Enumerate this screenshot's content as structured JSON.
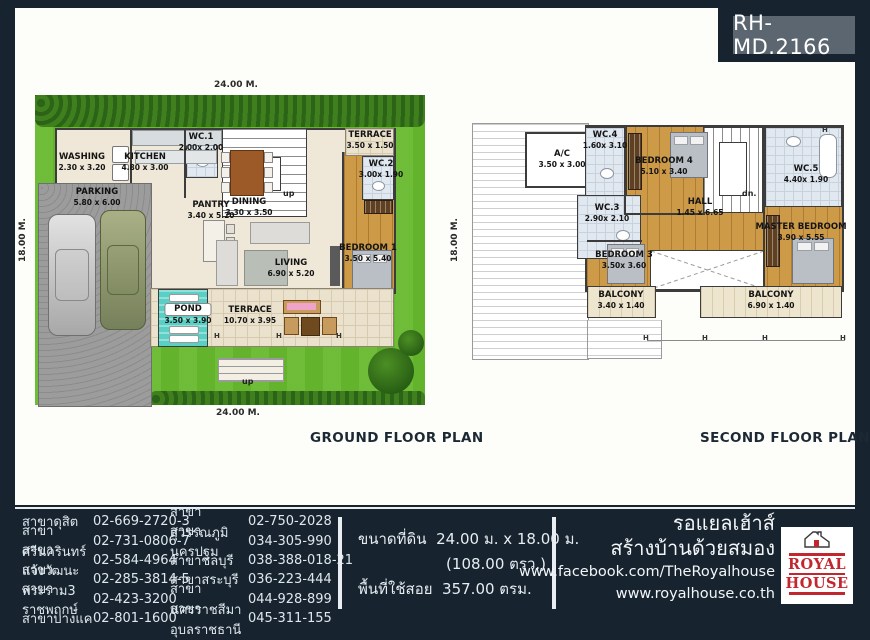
{
  "badge": "RH-MD.2166",
  "marker": "H",
  "ground_floor": {
    "title": "GROUND FLOOR PLAN",
    "dim_top": "24.00 M.",
    "dim_bottom": "24.00 M.",
    "dim_left": "18.00 M.",
    "dim_right": "18.00 M.",
    "stair_up_top": "up",
    "stair_up_bottom": "up",
    "rooms": [
      {
        "name": "WASHING",
        "dims": "2.30 x 3.20"
      },
      {
        "name": "KITCHEN",
        "dims": "4.80 x 3.00"
      },
      {
        "name": "WC.1",
        "dims": "2.00x 2.00"
      },
      {
        "name": "PARKING",
        "dims": "5.80 x 6.00"
      },
      {
        "name": "PANTRY",
        "dims": "3.40 x 5.20"
      },
      {
        "name": "DINING",
        "dims": "3.30 x 3.50"
      },
      {
        "name": "TERRACE",
        "dims": "3.50 x 1.50"
      },
      {
        "name": "WC.2",
        "dims": "3.00x 1.90"
      },
      {
        "name": "BEDROOM 1",
        "dims": "3.50 x 5.40"
      },
      {
        "name": "LIVING",
        "dims": "6.90 x 5.20"
      },
      {
        "name": "POND",
        "dims": "3.50 x 3.90"
      },
      {
        "name": "TERRACE",
        "dims": "10.70 x 3.95"
      }
    ]
  },
  "second_floor": {
    "title": "SECOND FLOOR PLAN",
    "stair_down": "dn.",
    "rooms": [
      {
        "name": "A/C",
        "dims": "3.50 x 3.00"
      },
      {
        "name": "WC.4",
        "dims": "1.60x 3.10"
      },
      {
        "name": "WC.3",
        "dims": "2.90x 2.10"
      },
      {
        "name": "BEDROOM 4",
        "dims": "5.10 x 3.40"
      },
      {
        "name": "WC.5",
        "dims": "4.40x 1.90"
      },
      {
        "name": "HALL",
        "dims": "1.45 x 6.65"
      },
      {
        "name": "MASTER BEDROOM",
        "dims": "3.90 x 5.55"
      },
      {
        "name": "BEDROOM 3",
        "dims": "3.50x 3.60"
      },
      {
        "name": "BALCONY",
        "dims": "3.40 x 1.40"
      },
      {
        "name": "BALCONY",
        "dims": "6.90 x 1.40"
      }
    ]
  },
  "footer": {
    "branches_col1": [
      {
        "name": "สาขาดุสิต",
        "phone": "02-669-2720-3"
      },
      {
        "name": "สาขาศรีนครินทร์",
        "phone": "02-731-0806-7"
      },
      {
        "name": "สาขาแจ้งวัฒนะ",
        "phone": "02-584-4964"
      },
      {
        "name": "สาขาพระราม3",
        "phone": "02-285-3814-5"
      },
      {
        "name": "สาขาราชพฤกษ์",
        "phone": "02-423-3200"
      },
      {
        "name": "สาขาบางแค",
        "phone": "02-801-1600"
      }
    ],
    "branches_col2": [
      {
        "name": "สาขาสุวรรณภูมิ",
        "phone": "02-750-2028"
      },
      {
        "name": "สาขานครปฐม",
        "phone": "034-305-990"
      },
      {
        "name": "สาขาชลบุรี",
        "phone": "038-388-018-21"
      },
      {
        "name": "สาขาสระบุรี",
        "phone": "036-223-444"
      },
      {
        "name": "สาขานครราชสีมา",
        "phone": "044-928-899"
      },
      {
        "name": "สาขาอุบลราชธานี",
        "phone": "045-311-155"
      }
    ],
    "land_label": "ขนาดที่ดิน",
    "land_value": "24.00 ม. x 18.00 ม.",
    "land_sub": "(108.00 ตรว.)",
    "area_label": "พื้นที่ใช้สอย",
    "area_value": "357.00 ตรม.",
    "brand_line1": "รอแยลเฮ้าส์",
    "brand_line2": "สร้างบ้านด้วยสมอง",
    "facebook": "www.facebook.com/TheRoyalhouse",
    "website": "www.royalhouse.co.th",
    "logo_word1": "ROYAL",
    "logo_word2": "HOUSE"
  },
  "colors": {
    "background": "#17232e",
    "badge": "#5b6670",
    "lawn": "#67b92e",
    "wood_floor": "#cd9a47",
    "pond": "#59cfc5",
    "logo_red": "#c2272f"
  }
}
